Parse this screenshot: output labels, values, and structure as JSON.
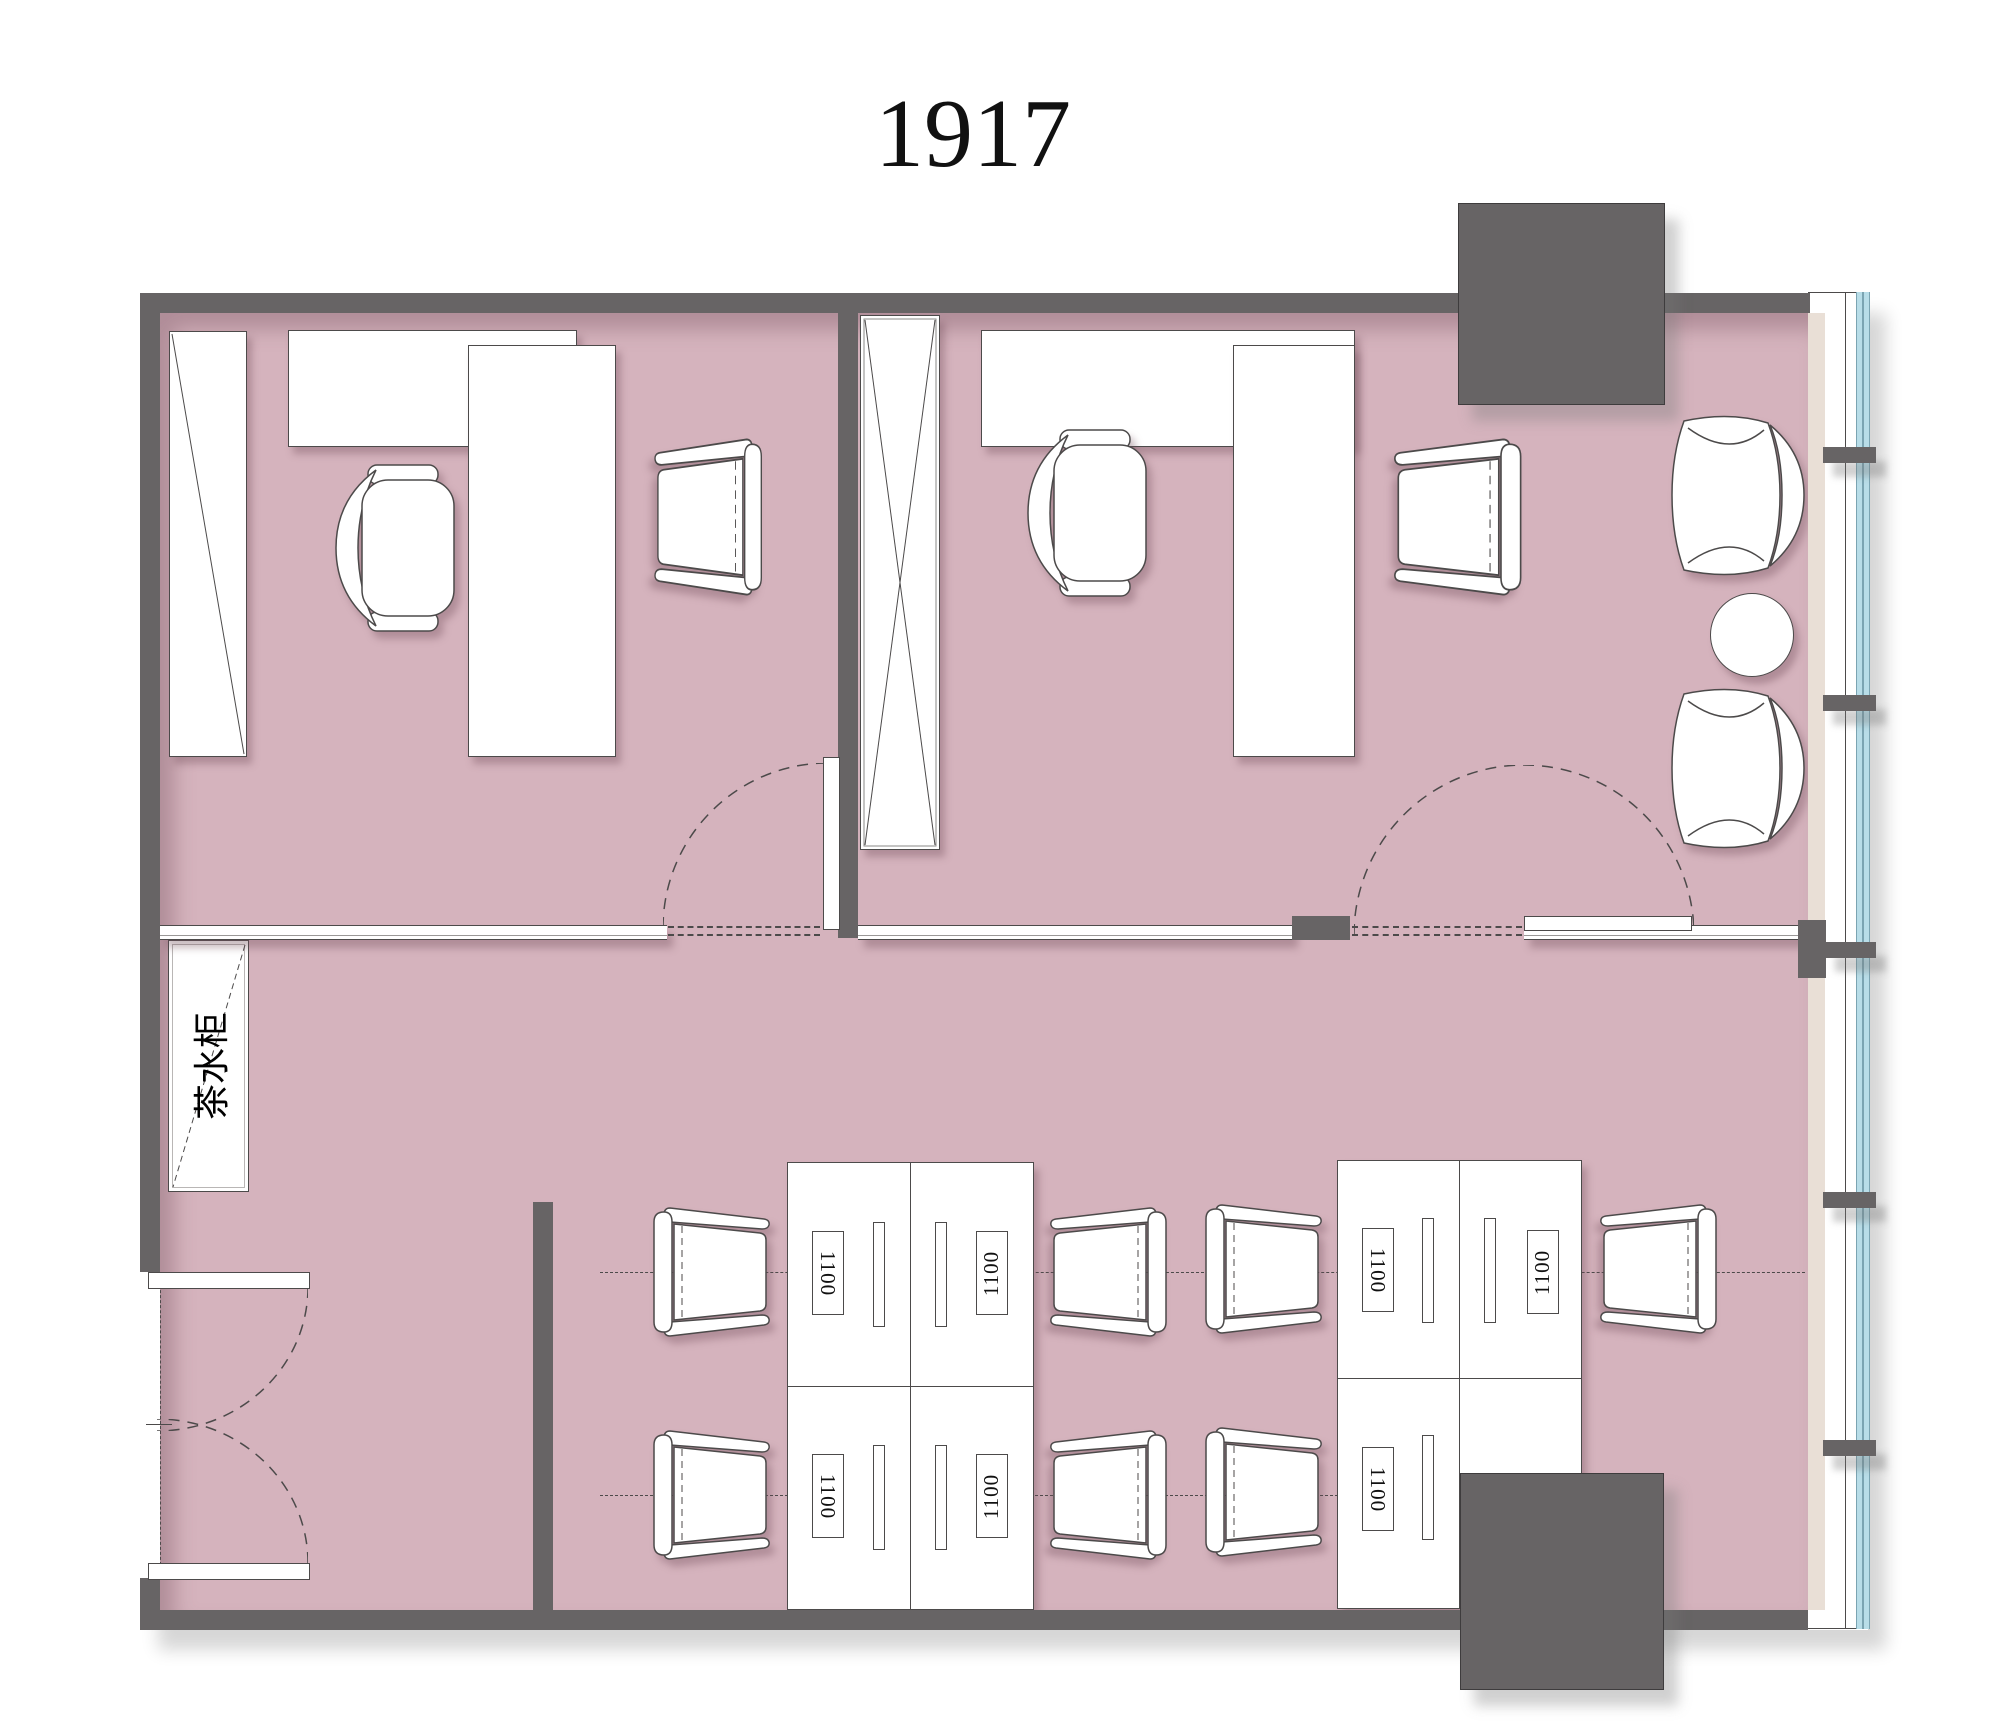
{
  "title": "1917",
  "tea_cabinet_label": "茶水柜",
  "desks": {
    "left_cluster": [
      "1100",
      "1100",
      "1100",
      "1100"
    ],
    "right_cluster": [
      "1100",
      "1100",
      "1100"
    ]
  },
  "colors": {
    "floor": "#d5b3bd",
    "wall": "#676465",
    "outline": "#4c4a4a",
    "window_finish_beige": "#e9dfd6",
    "glazing_blue": "#b8dde8",
    "furniture_fill": "#ffffff"
  },
  "icons": {
    "door_swing_arc": "dashed quarter/half circle",
    "cabinet_cross": "X-braced tall cabinet",
    "wardrobe_diagonal": "single diagonal cabinet"
  }
}
